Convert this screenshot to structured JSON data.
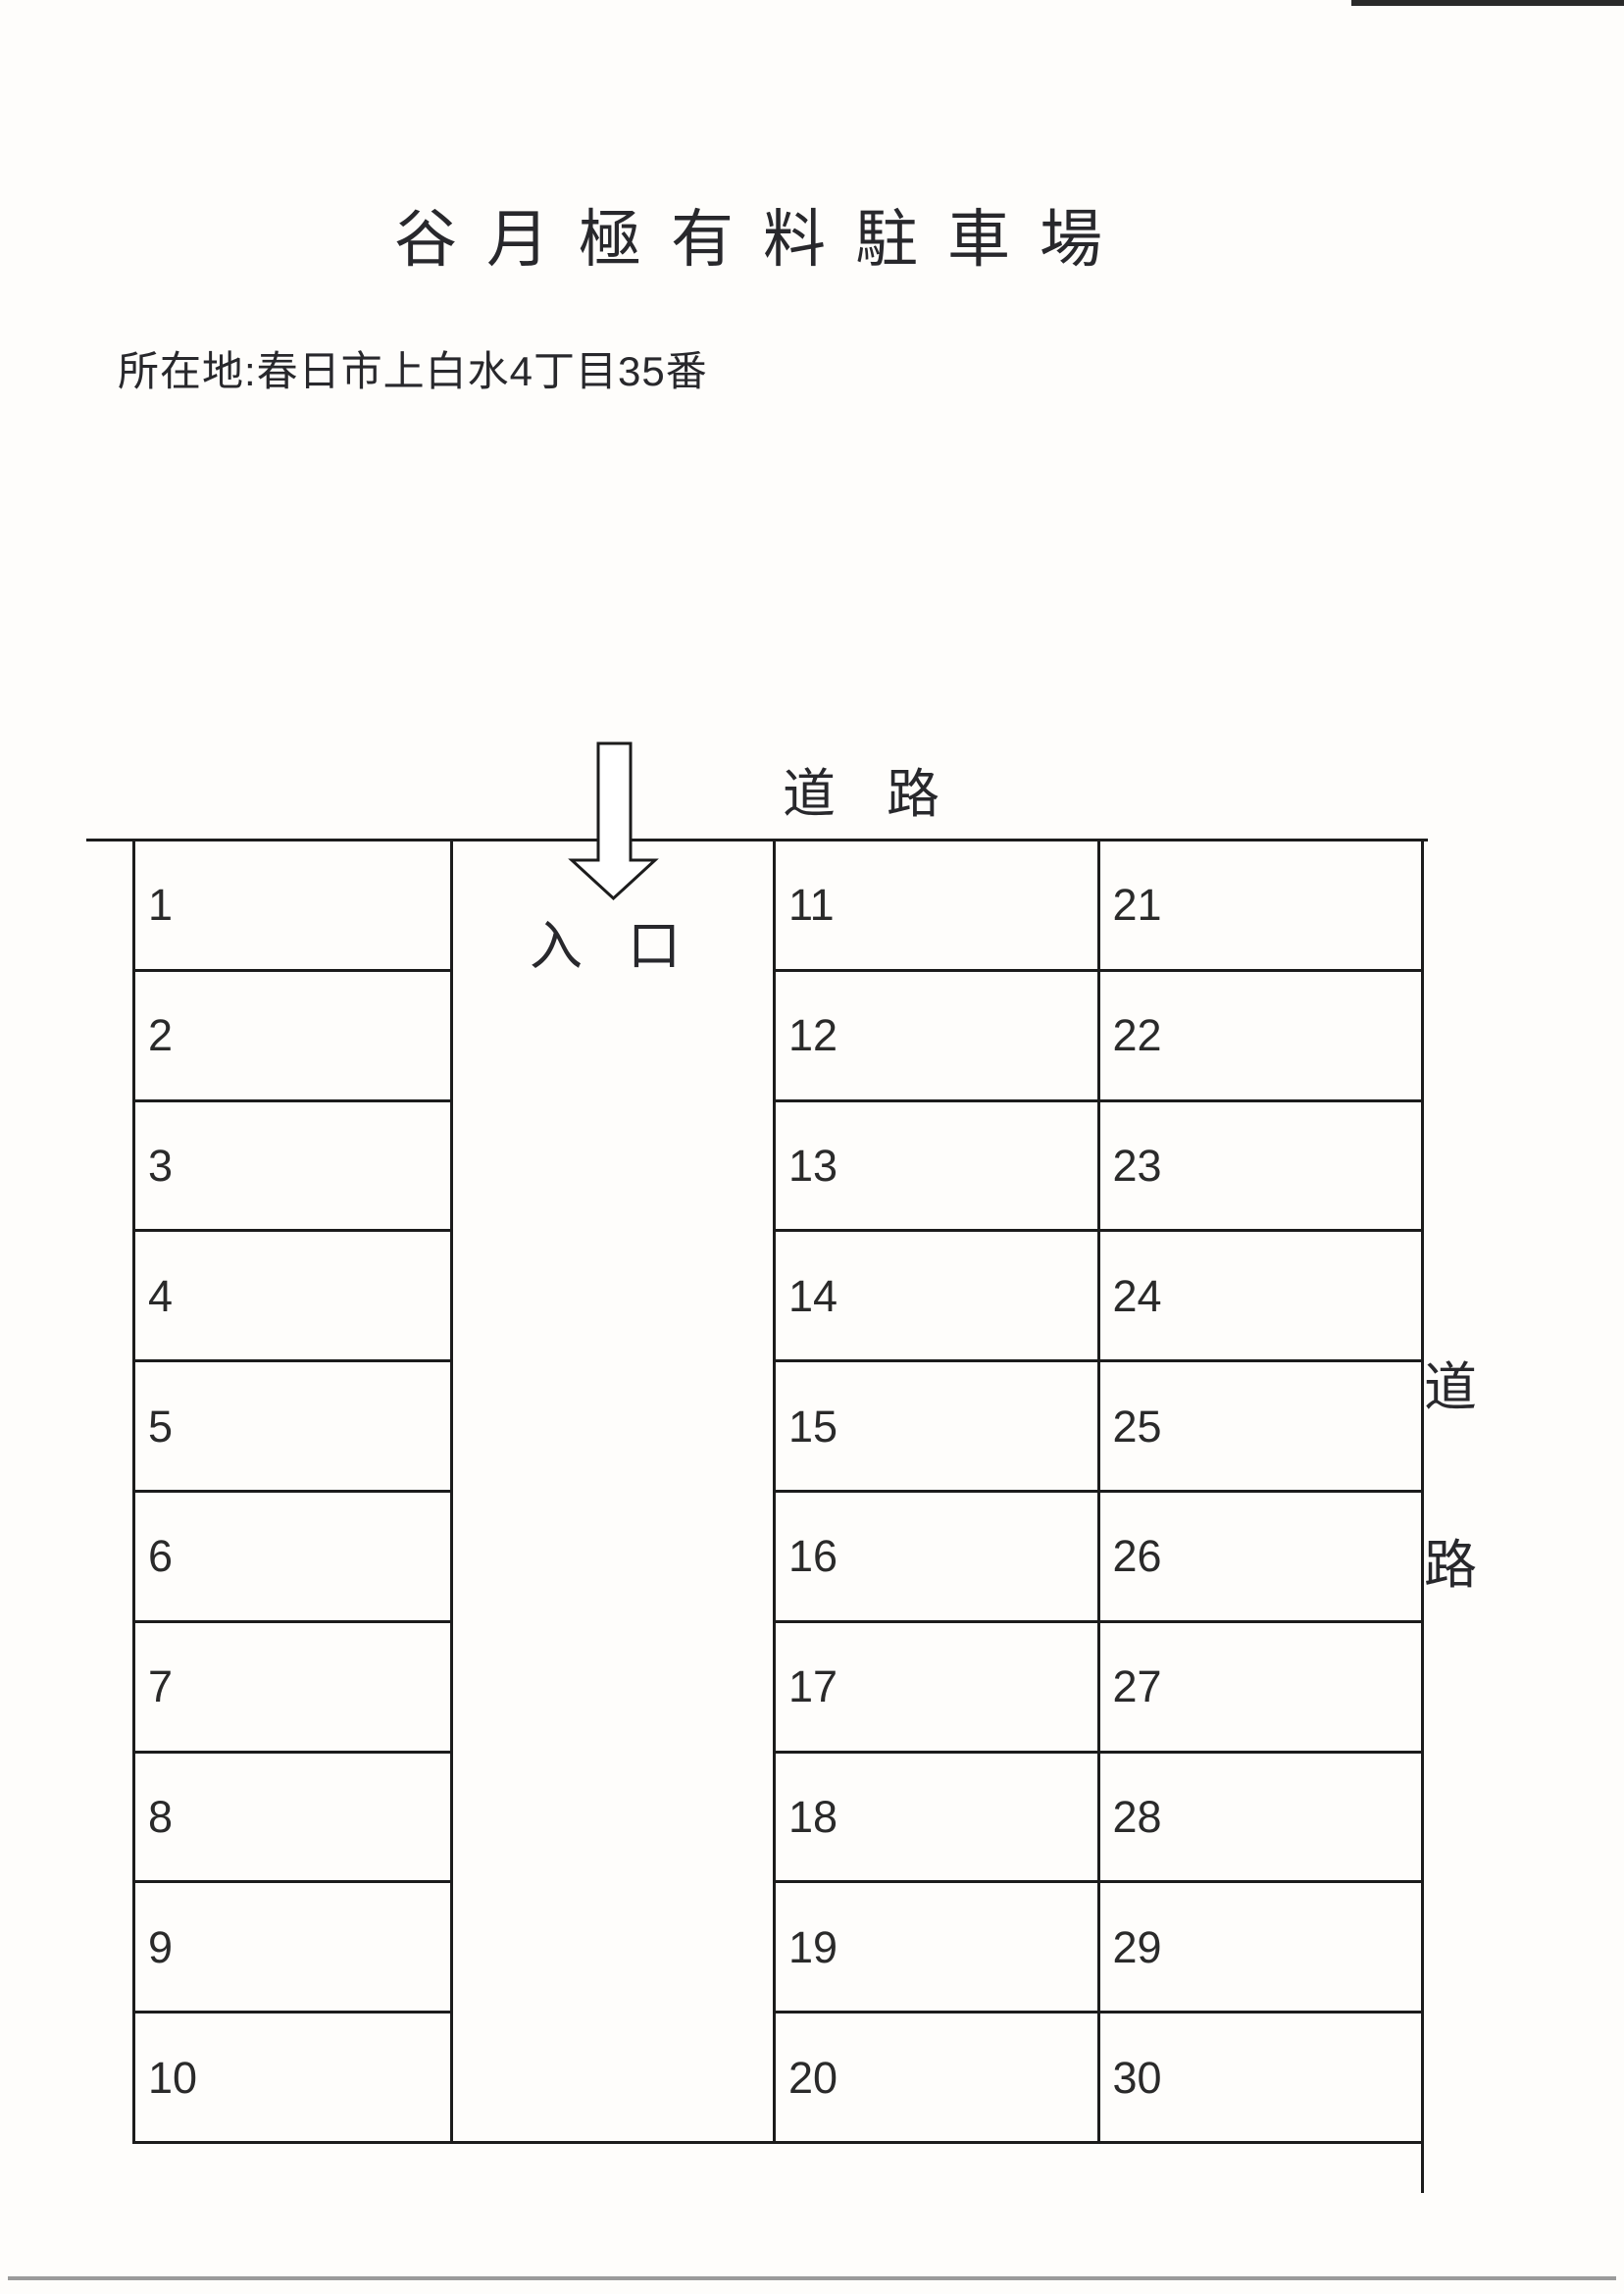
{
  "title": "谷月極有料駐車場",
  "address": "所在地:春日市上白水4丁目35番",
  "labels": {
    "road_top": [
      "道",
      "路"
    ],
    "road_right": [
      "道",
      "路"
    ],
    "entrance": [
      "入",
      "口"
    ]
  },
  "lot": {
    "left_spaces": [
      "1",
      "2",
      "3",
      "4",
      "5",
      "6",
      "7",
      "8",
      "9",
      "10"
    ],
    "middle_spaces": [
      "11",
      "12",
      "13",
      "14",
      "15",
      "16",
      "17",
      "18",
      "19",
      "20"
    ],
    "right_spaces": [
      "21",
      "22",
      "23",
      "24",
      "25",
      "26",
      "27",
      "28",
      "29",
      "30"
    ]
  },
  "colors": {
    "ink": "#28282c",
    "line": "#1c1c1c",
    "paper": "#fefdfb",
    "scan_artifact_gray": "#9b9b9b"
  }
}
